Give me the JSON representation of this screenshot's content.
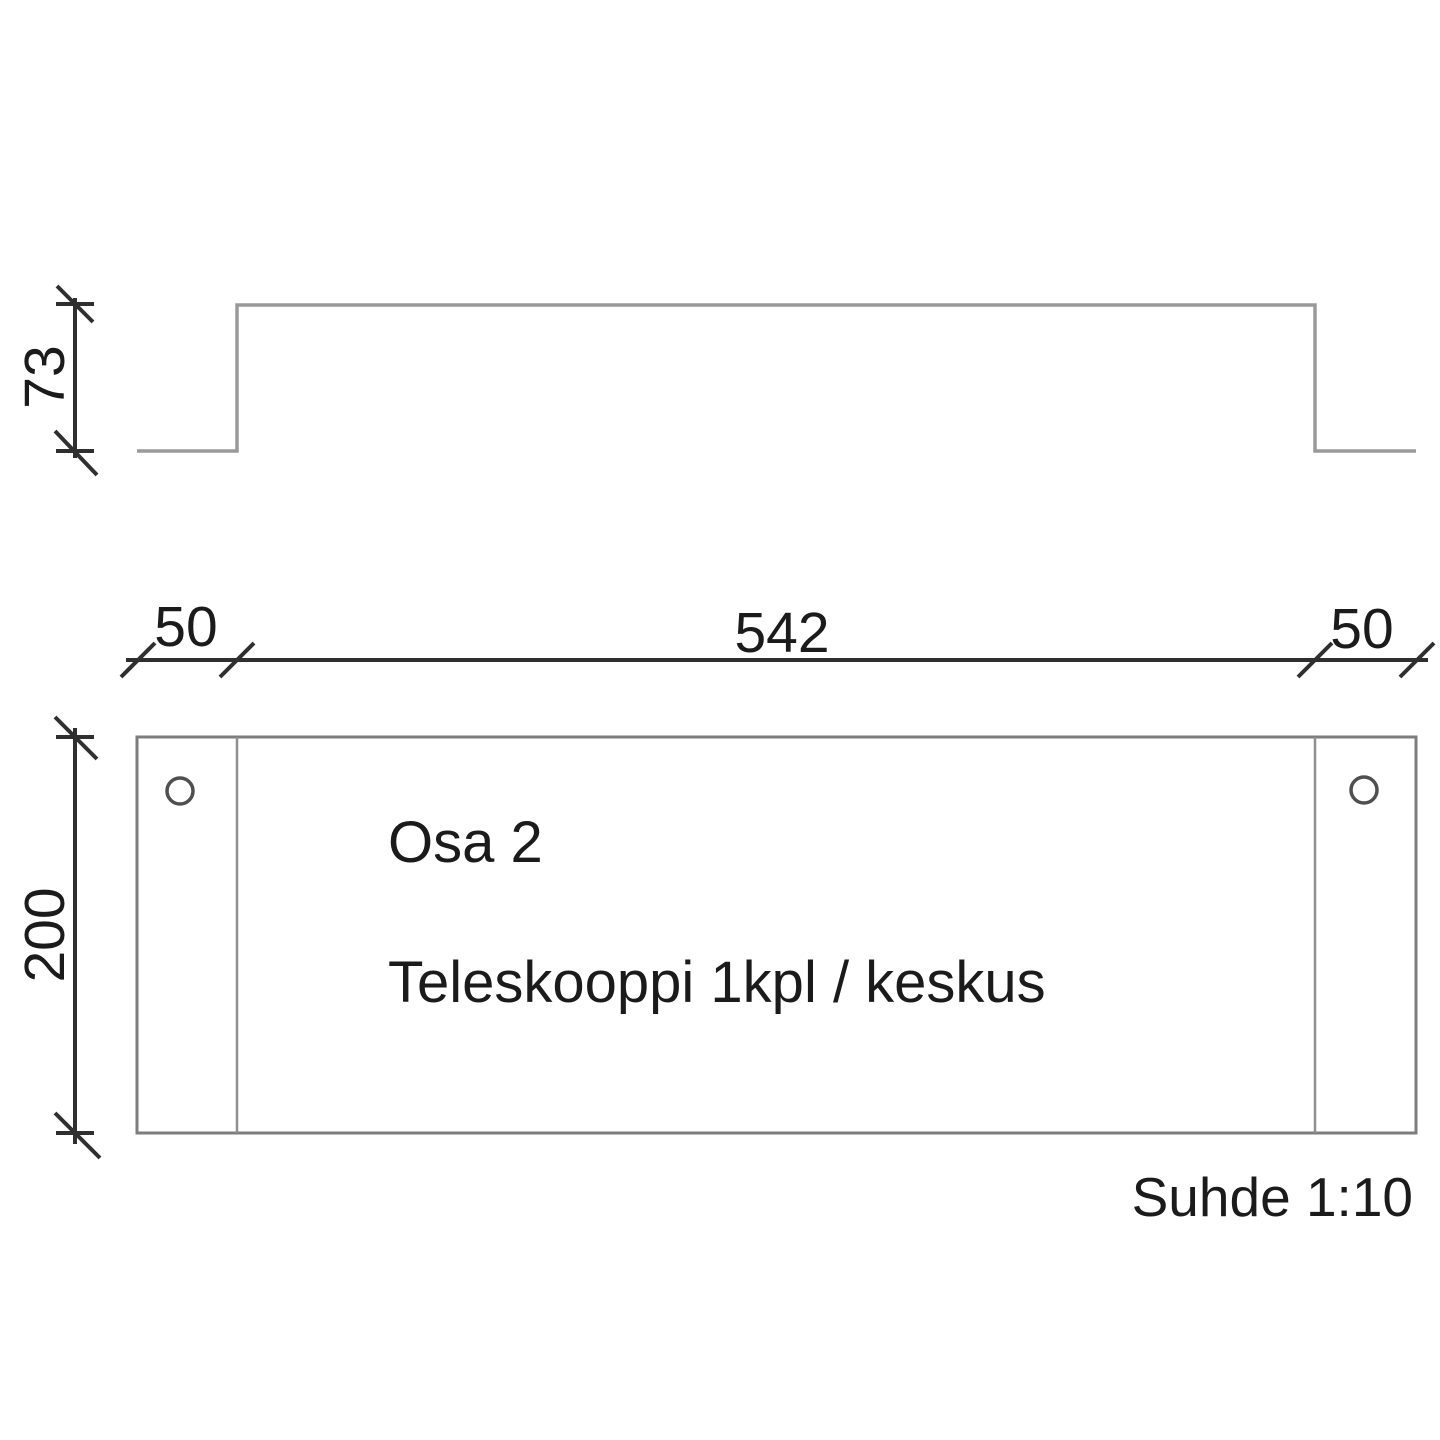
{
  "drawing": {
    "part": {
      "name": "Osa 2",
      "description": "Teleskooppi 1kpl / keskus"
    },
    "scale_note": "Suhde 1:10",
    "dimensions": {
      "profile_height": "73",
      "left_flange_width": "50",
      "body_width": "542",
      "right_flange_width": "50",
      "plate_height": "200"
    },
    "features": {
      "holes_count": 2
    },
    "colors": {
      "outline_gray": "#9a9a9a",
      "plate_outline_gray": "#7d7d7d",
      "dimension_dark": "#2f2f2f",
      "text_dark": "#1b1b1b",
      "background": "#ffffff"
    }
  }
}
